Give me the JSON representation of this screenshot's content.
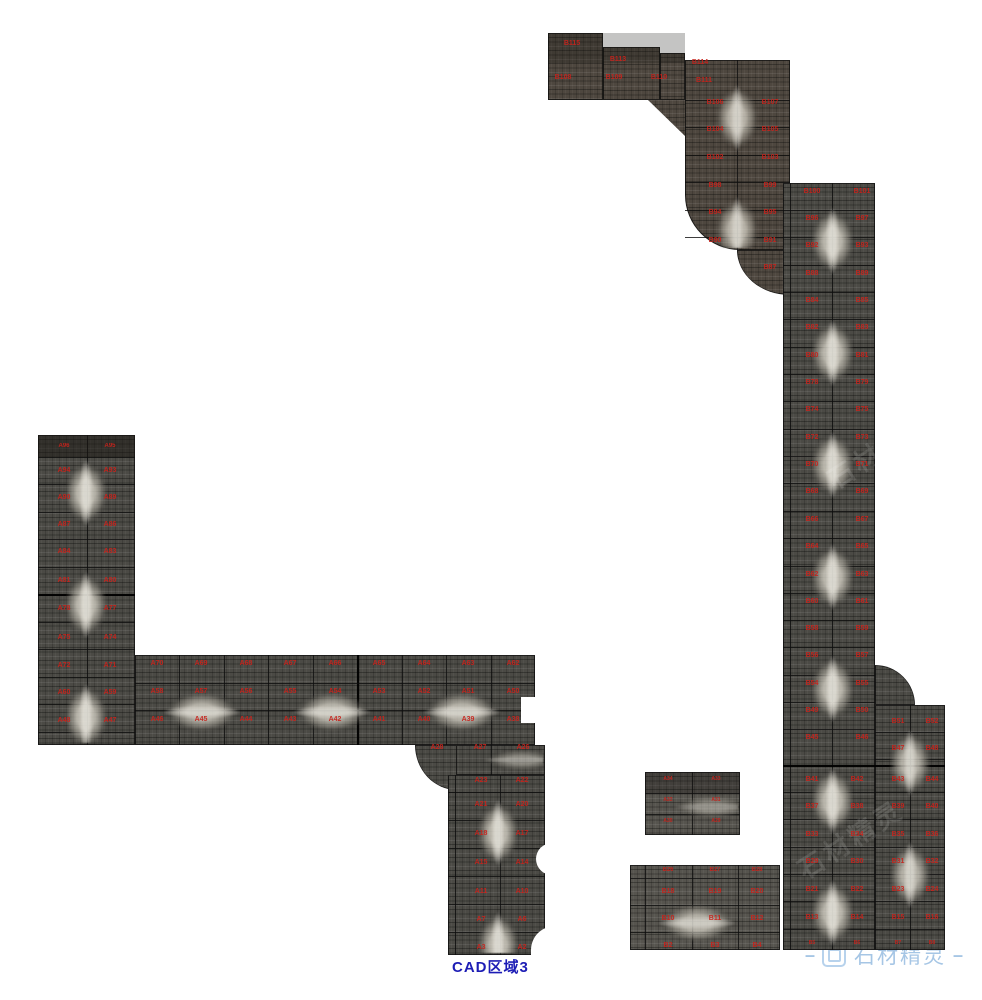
{
  "app": {
    "view_name": "stone-slab-layout-canvas"
  },
  "footer": {
    "title": "CAD区域3",
    "title_color": "#1d1db5"
  },
  "watermark": {
    "dash_left": "–",
    "text": "石材精灵",
    "dash_right": "–",
    "color": "#a6c6e5",
    "icon": "rounded-square-logo",
    "ghost_text": "石材精灵"
  },
  "palette": {
    "label_red": "#c8231c",
    "grid_line": "#141414",
    "stone_dark": "#4b4a45",
    "stone_vein": "#dcd8cc",
    "background": "#ffffff"
  },
  "regions": [
    {
      "name": "top-strip-1",
      "rect": [
        548,
        33,
        55,
        67
      ],
      "tone": "tone-a",
      "vlines": [],
      "hlines": []
    },
    {
      "name": "top-strip-2",
      "rect": [
        603,
        47,
        57,
        53
      ],
      "tone": "tone-a",
      "vlines": [],
      "hlines": []
    },
    {
      "name": "top-strip-3",
      "rect": [
        660,
        53,
        25,
        47
      ],
      "tone": "tone-a",
      "vlines": [],
      "hlines": []
    },
    {
      "name": "top-strip-diagonal",
      "rect": [
        648,
        100,
        37,
        36
      ],
      "tone": "tone-a",
      "clip": "polygon(0 0,100% 0,100% 100%)",
      "vlines": [],
      "hlines": []
    },
    {
      "name": "upper-column",
      "rect": [
        685,
        60,
        105,
        190
      ],
      "tone": "tone-a",
      "radius": "0 0 0 55px",
      "vlines": [
        52
      ],
      "hlines": [
        40,
        67,
        95,
        122,
        150,
        177
      ]
    },
    {
      "name": "upper-column-stub",
      "rect": [
        737,
        250,
        53,
        45
      ],
      "tone": "tone-a",
      "radius": "0 0 0 100%",
      "vlines": [],
      "hlines": []
    },
    {
      "name": "tall-column",
      "rect": [
        783,
        183,
        92,
        767
      ],
      "tone": "tone-b",
      "vlines": [
        7,
        49
      ],
      "hlines": [
        27,
        54,
        82,
        109,
        136,
        164,
        191,
        218,
        246,
        273,
        300,
        328,
        355,
        383,
        410,
        437,
        464,
        492,
        519,
        546,
        609,
        636,
        664,
        691,
        718,
        746
      ],
      "hlines_thick": [
        582
      ]
    },
    {
      "name": "right-extension",
      "rect": [
        875,
        705,
        70,
        245
      ],
      "tone": "tone-b",
      "vlines": [
        35
      ],
      "hlines": [
        27,
        54,
        87,
        114,
        142,
        169,
        196,
        224
      ],
      "hlines_thick": [
        60
      ]
    },
    {
      "name": "right-extension-fillet",
      "rect": [
        875,
        665,
        40,
        40
      ],
      "tone": "tone-b",
      "radius": "0 100% 0 0",
      "vlines": [],
      "hlines": []
    },
    {
      "name": "left-column",
      "rect": [
        38,
        435,
        97,
        310
      ],
      "tone": "tone-b",
      "vlines": [
        49
      ],
      "hlines": [
        22,
        49,
        77,
        104,
        132,
        187,
        214,
        242,
        269,
        297
      ],
      "hlines_thick": [
        159
      ]
    },
    {
      "name": "horizontal-strip",
      "rect": [
        135,
        655,
        400,
        90
      ],
      "tone": "tone-b",
      "vlines": [
        44,
        89,
        133,
        178,
        267,
        311,
        356
      ],
      "vlines_thick": [
        222
      ],
      "hlines": [
        28,
        55
      ]
    },
    {
      "name": "strip-extension",
      "rect": [
        455,
        745,
        90,
        30
      ],
      "tone": "tone-b",
      "vlines": [
        36
      ],
      "hlines": []
    },
    {
      "name": "strip-extension-fillet",
      "rect": [
        415,
        745,
        42,
        45
      ],
      "tone": "tone-b",
      "radius": "0 0 0 100%",
      "vlines": [],
      "hlines": []
    },
    {
      "name": "bottom-strip",
      "rect": [
        448,
        775,
        97,
        180
      ],
      "tone": "tone-b",
      "vlines": [
        7,
        52
      ],
      "hlines": [
        17,
        45,
        73,
        101,
        129,
        157
      ]
    },
    {
      "name": "bottom-left-block",
      "rect": [
        630,
        865,
        150,
        85
      ],
      "tone": "tone-c",
      "vlines": [
        15,
        62,
        108
      ],
      "hlines": [
        13,
        40,
        67
      ]
    },
    {
      "name": "small-block",
      "rect": [
        645,
        772,
        95,
        63
      ],
      "tone": "tone-c",
      "vlines": [
        47
      ],
      "hlines": [
        21,
        42
      ]
    }
  ],
  "veins": [
    {
      "x": 58,
      "y": 437,
      "w": 56,
      "h": 306,
      "dir": "v",
      "op": 0.9
    },
    {
      "x": 709,
      "y": 62,
      "w": 56,
      "h": 186,
      "dir": "v",
      "op": 0.85
    },
    {
      "x": 804,
      "y": 185,
      "w": 57,
      "h": 763,
      "dir": "v",
      "op": 0.9
    },
    {
      "x": 883,
      "y": 707,
      "w": 54,
      "h": 241,
      "dir": "v",
      "op": 0.85
    },
    {
      "x": 471,
      "y": 777,
      "w": 54,
      "h": 176,
      "dir": "v",
      "op": 0.9
    },
    {
      "x": 137,
      "y": 686,
      "w": 396,
      "h": 52,
      "dir": "h",
      "op": 0.85
    },
    {
      "x": 632,
      "y": 898,
      "w": 146,
      "h": 50,
      "dir": "h",
      "op": 0.8
    },
    {
      "x": 647,
      "y": 792,
      "w": 91,
      "h": 30,
      "dir": "h",
      "op": 0.45
    },
    {
      "x": 457,
      "y": 746,
      "w": 86,
      "h": 28,
      "dir": "h",
      "op": 0.5
    }
  ],
  "bites": [
    {
      "x": 521,
      "y": 697,
      "w": 16,
      "h": 26,
      "r": "0"
    },
    {
      "x": 536,
      "y": 843,
      "w": 22,
      "h": 32,
      "r": "16px 0 0 16px"
    },
    {
      "x": 531,
      "y": 926,
      "w": 27,
      "h": 32,
      "r": "24px 0 0 0"
    }
  ],
  "shades": [
    {
      "x": 38,
      "y": 435,
      "w": 97,
      "h": 22,
      "c": "rgba(25,22,18,.5)"
    },
    {
      "x": 548,
      "y": 33,
      "w": 137,
      "h": 30,
      "c": "rgba(20,18,15,.25)"
    },
    {
      "x": 645,
      "y": 772,
      "w": 95,
      "h": 21,
      "c": "rgba(20,18,15,.3)"
    }
  ],
  "ghost_marks": [
    {
      "x": 790,
      "y": 820
    },
    {
      "x": 820,
      "y": 430
    }
  ],
  "labels": [
    [
      572,
      40,
      "B115"
    ],
    [
      618,
      56,
      "B113"
    ],
    [
      700,
      59,
      "B114"
    ],
    [
      563,
      74,
      "B108"
    ],
    [
      614,
      74,
      "B109"
    ],
    [
      659,
      74,
      "B110"
    ],
    [
      704,
      77,
      "B111"
    ],
    [
      715,
      99,
      "B106"
    ],
    [
      770,
      99,
      "B107"
    ],
    [
      715,
      126,
      "B104"
    ],
    [
      770,
      126,
      "B105"
    ],
    [
      715,
      154,
      "B102"
    ],
    [
      770,
      154,
      "B103"
    ],
    [
      715,
      182,
      "B98"
    ],
    [
      770,
      182,
      "B99"
    ],
    [
      715,
      209,
      "B94"
    ],
    [
      770,
      209,
      "B95"
    ],
    [
      715,
      237,
      "B90"
    ],
    [
      770,
      237,
      "B91"
    ],
    [
      770,
      264,
      "B87"
    ],
    [
      812,
      188,
      "B100"
    ],
    [
      862,
      188,
      "B101"
    ],
    [
      812,
      215,
      "B96"
    ],
    [
      862,
      215,
      "B97"
    ],
    [
      812,
      242,
      "B92"
    ],
    [
      862,
      242,
      "B93"
    ],
    [
      812,
      270,
      "B88"
    ],
    [
      862,
      270,
      "B89"
    ],
    [
      812,
      297,
      "B84"
    ],
    [
      862,
      297,
      "B85"
    ],
    [
      812,
      324,
      "B82"
    ],
    [
      862,
      324,
      "B83"
    ],
    [
      812,
      352,
      "B80"
    ],
    [
      862,
      352,
      "B81"
    ],
    [
      812,
      379,
      "B78"
    ],
    [
      862,
      379,
      "B79"
    ],
    [
      812,
      406,
      "B74"
    ],
    [
      862,
      406,
      "B75"
    ],
    [
      812,
      434,
      "B72"
    ],
    [
      862,
      434,
      "B73"
    ],
    [
      812,
      461,
      "B70"
    ],
    [
      862,
      461,
      "B71"
    ],
    [
      812,
      488,
      "B68"
    ],
    [
      862,
      488,
      "B69"
    ],
    [
      812,
      516,
      "B66"
    ],
    [
      862,
      516,
      "B67"
    ],
    [
      812,
      543,
      "B64"
    ],
    [
      862,
      543,
      "B65"
    ],
    [
      812,
      571,
      "B62"
    ],
    [
      862,
      571,
      "B63"
    ],
    [
      812,
      598,
      "B60"
    ],
    [
      862,
      598,
      "B61"
    ],
    [
      812,
      625,
      "B58"
    ],
    [
      862,
      625,
      "B59"
    ],
    [
      812,
      652,
      "B56"
    ],
    [
      862,
      652,
      "B57"
    ],
    [
      812,
      680,
      "B54"
    ],
    [
      862,
      680,
      "B55"
    ],
    [
      812,
      707,
      "B49"
    ],
    [
      862,
      707,
      "B50"
    ],
    [
      812,
      734,
      "B45"
    ],
    [
      862,
      734,
      "B46"
    ],
    [
      898,
      718,
      "B51"
    ],
    [
      932,
      718,
      "B52"
    ],
    [
      898,
      745,
      "B47"
    ],
    [
      932,
      745,
      "B48"
    ],
    [
      812,
      776,
      "B41"
    ],
    [
      857,
      776,
      "B42"
    ],
    [
      898,
      776,
      "B43"
    ],
    [
      932,
      776,
      "B44"
    ],
    [
      812,
      803,
      "B37"
    ],
    [
      857,
      803,
      "B38"
    ],
    [
      898,
      803,
      "B39"
    ],
    [
      932,
      803,
      "B40"
    ],
    [
      812,
      831,
      "B33"
    ],
    [
      857,
      831,
      "B34"
    ],
    [
      898,
      831,
      "B35"
    ],
    [
      932,
      831,
      "B36"
    ],
    [
      812,
      858,
      "B29"
    ],
    [
      857,
      858,
      "B30"
    ],
    [
      898,
      858,
      "B31"
    ],
    [
      932,
      858,
      "B32"
    ],
    [
      812,
      886,
      "B21"
    ],
    [
      857,
      886,
      "B22"
    ],
    [
      898,
      886,
      "B23"
    ],
    [
      932,
      886,
      "B24"
    ],
    [
      812,
      914,
      "B13"
    ],
    [
      857,
      914,
      "B14"
    ],
    [
      898,
      914,
      "B15"
    ],
    [
      932,
      914,
      "B16"
    ],
    [
      812,
      941,
      "B5",
      5
    ],
    [
      857,
      941,
      "B6",
      5
    ],
    [
      898,
      941,
      "B7",
      5
    ],
    [
      932,
      941,
      "B8",
      5
    ],
    [
      668,
      867,
      "B26",
      6
    ],
    [
      715,
      867,
      "B27",
      6
    ],
    [
      757,
      867,
      "B28",
      6
    ],
    [
      668,
      888,
      "B18"
    ],
    [
      715,
      888,
      "B19"
    ],
    [
      757,
      888,
      "B20"
    ],
    [
      668,
      915,
      "B10"
    ],
    [
      715,
      915,
      "B11"
    ],
    [
      757,
      915,
      "B12"
    ],
    [
      668,
      942,
      "B2"
    ],
    [
      715,
      942,
      "B3"
    ],
    [
      757,
      942,
      "B4"
    ],
    [
      64,
      443,
      "A96",
      6
    ],
    [
      110,
      443,
      "A95",
      6
    ],
    [
      64,
      467,
      "A94"
    ],
    [
      110,
      467,
      "A93"
    ],
    [
      64,
      494,
      "A90"
    ],
    [
      110,
      494,
      "A89"
    ],
    [
      64,
      521,
      "A87"
    ],
    [
      110,
      521,
      "A86"
    ],
    [
      64,
      548,
      "A84"
    ],
    [
      110,
      548,
      "A83"
    ],
    [
      64,
      577,
      "A81"
    ],
    [
      110,
      577,
      "A80"
    ],
    [
      64,
      605,
      "A78"
    ],
    [
      110,
      605,
      "A77"
    ],
    [
      64,
      634,
      "A75"
    ],
    [
      110,
      634,
      "A74"
    ],
    [
      64,
      662,
      "A72"
    ],
    [
      110,
      662,
      "A71"
    ],
    [
      64,
      689,
      "A60"
    ],
    [
      110,
      689,
      "A59"
    ],
    [
      64,
      717,
      "A48"
    ],
    [
      110,
      717,
      "A47"
    ],
    [
      157,
      660,
      "A70"
    ],
    [
      201,
      660,
      "A69"
    ],
    [
      246,
      660,
      "A68"
    ],
    [
      290,
      660,
      "A67"
    ],
    [
      335,
      660,
      "A66"
    ],
    [
      379,
      660,
      "A65"
    ],
    [
      424,
      660,
      "A64"
    ],
    [
      468,
      660,
      "A63"
    ],
    [
      513,
      660,
      "A62"
    ],
    [
      157,
      688,
      "A58"
    ],
    [
      201,
      688,
      "A57"
    ],
    [
      246,
      688,
      "A56"
    ],
    [
      290,
      688,
      "A55"
    ],
    [
      335,
      688,
      "A54"
    ],
    [
      379,
      688,
      "A53"
    ],
    [
      424,
      688,
      "A52"
    ],
    [
      468,
      688,
      "A51"
    ],
    [
      513,
      688,
      "A50"
    ],
    [
      157,
      716,
      "A46"
    ],
    [
      201,
      716,
      "A45"
    ],
    [
      246,
      716,
      "A44"
    ],
    [
      290,
      716,
      "A43"
    ],
    [
      335,
      716,
      "A42"
    ],
    [
      379,
      716,
      "A41"
    ],
    [
      424,
      716,
      "A40"
    ],
    [
      468,
      716,
      "A39"
    ],
    [
      513,
      716,
      "A38"
    ],
    [
      437,
      744,
      "A28"
    ],
    [
      480,
      744,
      "A27"
    ],
    [
      523,
      744,
      "A26"
    ],
    [
      481,
      777,
      "A23"
    ],
    [
      522,
      777,
      "A22"
    ],
    [
      481,
      801,
      "A21"
    ],
    [
      522,
      801,
      "A20"
    ],
    [
      481,
      830,
      "A18"
    ],
    [
      522,
      830,
      "A17"
    ],
    [
      481,
      859,
      "A15"
    ],
    [
      522,
      859,
      "A14"
    ],
    [
      481,
      888,
      "A11"
    ],
    [
      522,
      888,
      "A10"
    ],
    [
      481,
      916,
      "A7"
    ],
    [
      522,
      916,
      "A6"
    ],
    [
      481,
      944,
      "A3"
    ],
    [
      522,
      944,
      "A2"
    ],
    [
      668,
      777,
      "A34",
      5
    ],
    [
      716,
      777,
      "A33",
      5
    ],
    [
      668,
      798,
      "A32",
      5
    ],
    [
      716,
      798,
      "A31",
      5
    ],
    [
      668,
      819,
      "A30",
      5
    ],
    [
      716,
      819,
      "A29",
      5
    ]
  ]
}
